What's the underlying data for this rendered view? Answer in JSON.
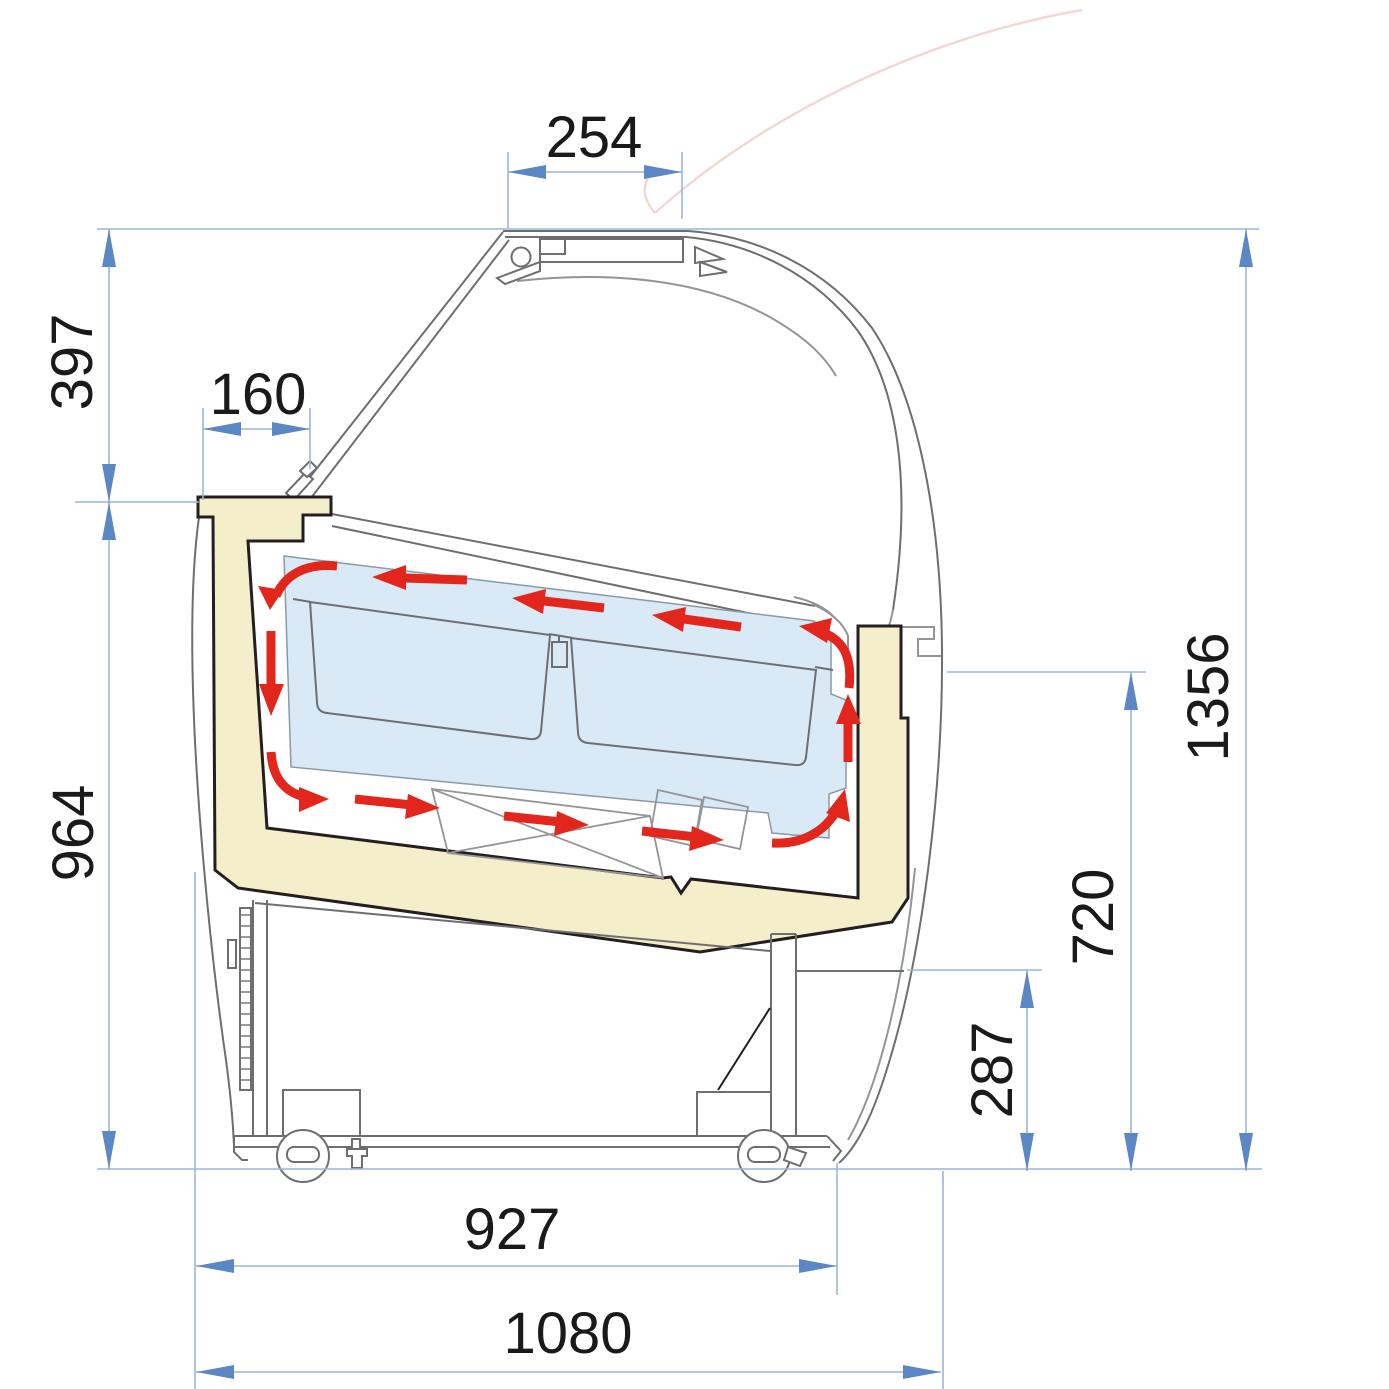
{
  "diagram": {
    "subject": "ice-cream display case cross-section with air circulation",
    "units_note": ""
  },
  "dimensions": {
    "top_opening_width": "254",
    "upper_section_height": "397",
    "worktop_depth": "160",
    "overall_height": "1356",
    "lower_section_height": "964",
    "rear_glass_height": "720",
    "base_compartment_height": "287",
    "base_depth": "927",
    "overall_depth": "1080"
  },
  "colors": {
    "dimension_line": "#9ab5d9",
    "dimension_arrow": "#5b87c5",
    "dimension_text": "#1a1a1a",
    "insulation_fill": "#f5eecb",
    "cold_zone_fill": "#d9eaf6",
    "airflow_arrow": "#e2261c",
    "outline_gray": "#6d6e71",
    "outline_light_gray": "#939598",
    "outline_black": "#231f20",
    "swing_arc_pink": "#f2d8d4"
  }
}
